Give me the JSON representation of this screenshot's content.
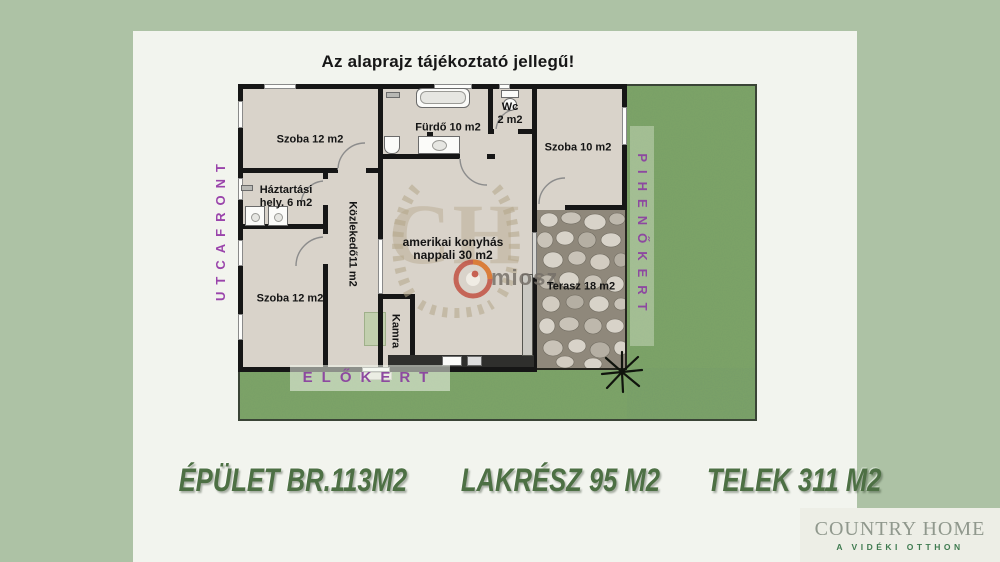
{
  "title": "Az alaprajz tájékoztató jellegű!",
  "rooms": {
    "szoba_tl": {
      "label": "Szoba 12 m2"
    },
    "furdo": {
      "label": "Fürdő 10 m2"
    },
    "wc": {
      "line1": "Wc",
      "line2": "2 m2"
    },
    "szoba_tr": {
      "label": "Szoba 10 m2"
    },
    "haztartasi": {
      "line1": "Háztartási",
      "line2": "hely. 6 m2"
    },
    "kozlekedo": {
      "label": "Közlekedő11 m2"
    },
    "szoba_bl": {
      "label": "Szoba 12 m2"
    },
    "kamra": {
      "label": "Kamra"
    },
    "nappali": {
      "line1": "amerikai konyhás",
      "line2": "nappali 30 m2"
    },
    "terasz": {
      "label": "Terasz 18 m2"
    }
  },
  "garden": {
    "street_side": "UTCAFRONT",
    "rest_garden": "PIHENŐKERT",
    "front_garden": "ELŐKERT"
  },
  "stats": {
    "building": "ÉPÜLET BR.113M2",
    "living": "LAKRÉSZ  95 M2",
    "plot": "TELEK 311 M2"
  },
  "watermark": {
    "monogram": "CH",
    "brand": "miosz"
  },
  "logo": {
    "name": "COUNTRY HOME",
    "tagline": "A VIDÉKI OTTHON"
  },
  "colors": {
    "page_bg": "#adc2a5",
    "panel_bg": "#f2f4ee",
    "grass_green": "#7ea566",
    "floor_beige": "#d9d3ca",
    "wall_black": "#161616",
    "garden_label_purple": "#8d49a0",
    "stats_green": "#4d7044",
    "logo_gray": "#90988d",
    "logo_green": "#3f7b50"
  }
}
